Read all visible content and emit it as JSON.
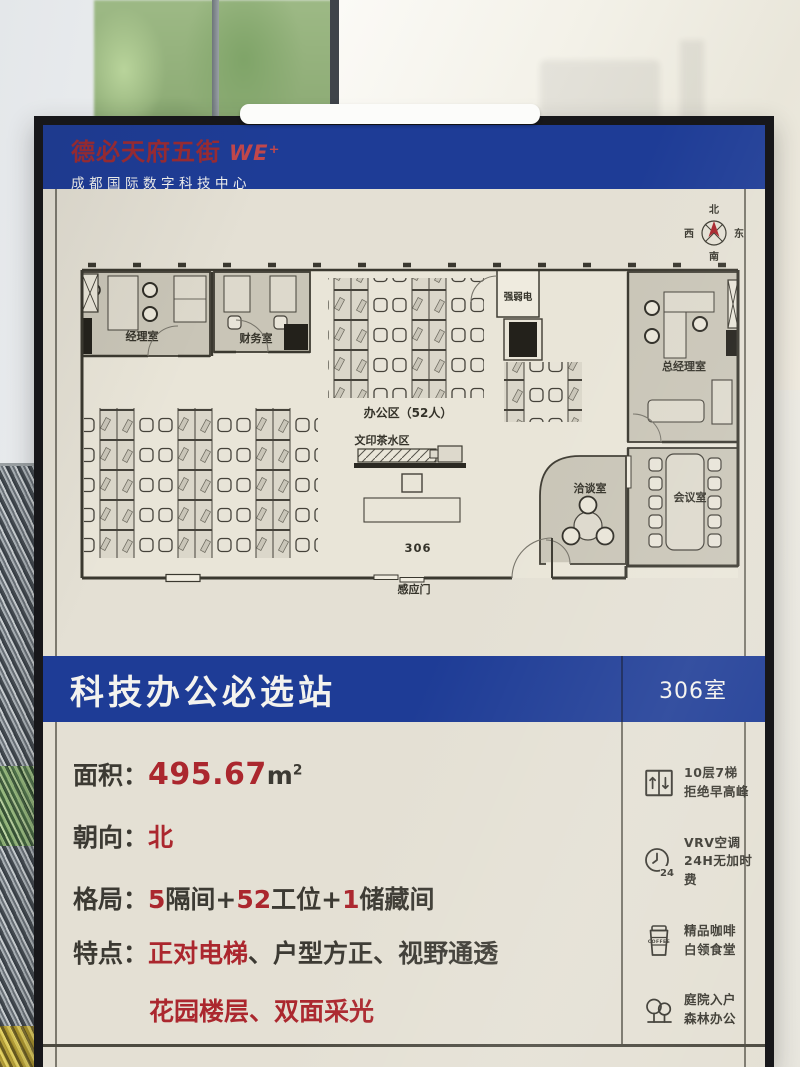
{
  "colors": {
    "banner_blue": "#1e3c96",
    "brand_red": "#9a2b33",
    "accent_red": "#ab272e",
    "board_cream": "#e4e0d4"
  },
  "header": {
    "brand": "德必天府五街",
    "logo": "WE⁺",
    "subtitle": "成都国际数字科技中心"
  },
  "compass": {
    "n": "北",
    "e": "东",
    "s": "南",
    "w": "西"
  },
  "floorplan": {
    "rooms": {
      "manager": "经理室",
      "finance": "财务室",
      "utility": "强弱电",
      "general_manager": "总经理室",
      "meeting": "会议室",
      "negotiation": "洽谈室"
    },
    "labels": {
      "office_area": "办公区（52人）",
      "print_tea": "文印茶水区",
      "room_number": "306",
      "sensor_door": "感应门"
    }
  },
  "banner": {
    "title": "科技办公必选站",
    "room": "306室"
  },
  "specs": {
    "area": {
      "label": "面积：",
      "value": "495.67",
      "unit": "m",
      "sup": "2"
    },
    "facing": {
      "label": "朝向：",
      "value": "北"
    },
    "layout": {
      "label": "格局：",
      "n1": "5",
      "t1": "隔间+",
      "n2": "52",
      "t2": "工位+",
      "n3": "1",
      "t3": "储藏间"
    },
    "features_label": "特点：",
    "f1_red": "正对电梯",
    "f1_sep1": "、",
    "f1_p1": "户型方正",
    "f1_sep2": "、",
    "f1_p2": "视野通透",
    "f2_red1": "花园楼层",
    "f2_sep": "、",
    "f2_red2": "双面采光"
  },
  "amenities": [
    {
      "line1": "10层7梯",
      "line2": "拒绝早高峰"
    },
    {
      "line1": "VRV空调",
      "line2": "24H无加时费",
      "badge": "24"
    },
    {
      "line1": "精品咖啡",
      "line2": "白领食堂",
      "badge": "COFFEE"
    },
    {
      "line1": "庭院入户",
      "line2": "森林办公"
    }
  ]
}
